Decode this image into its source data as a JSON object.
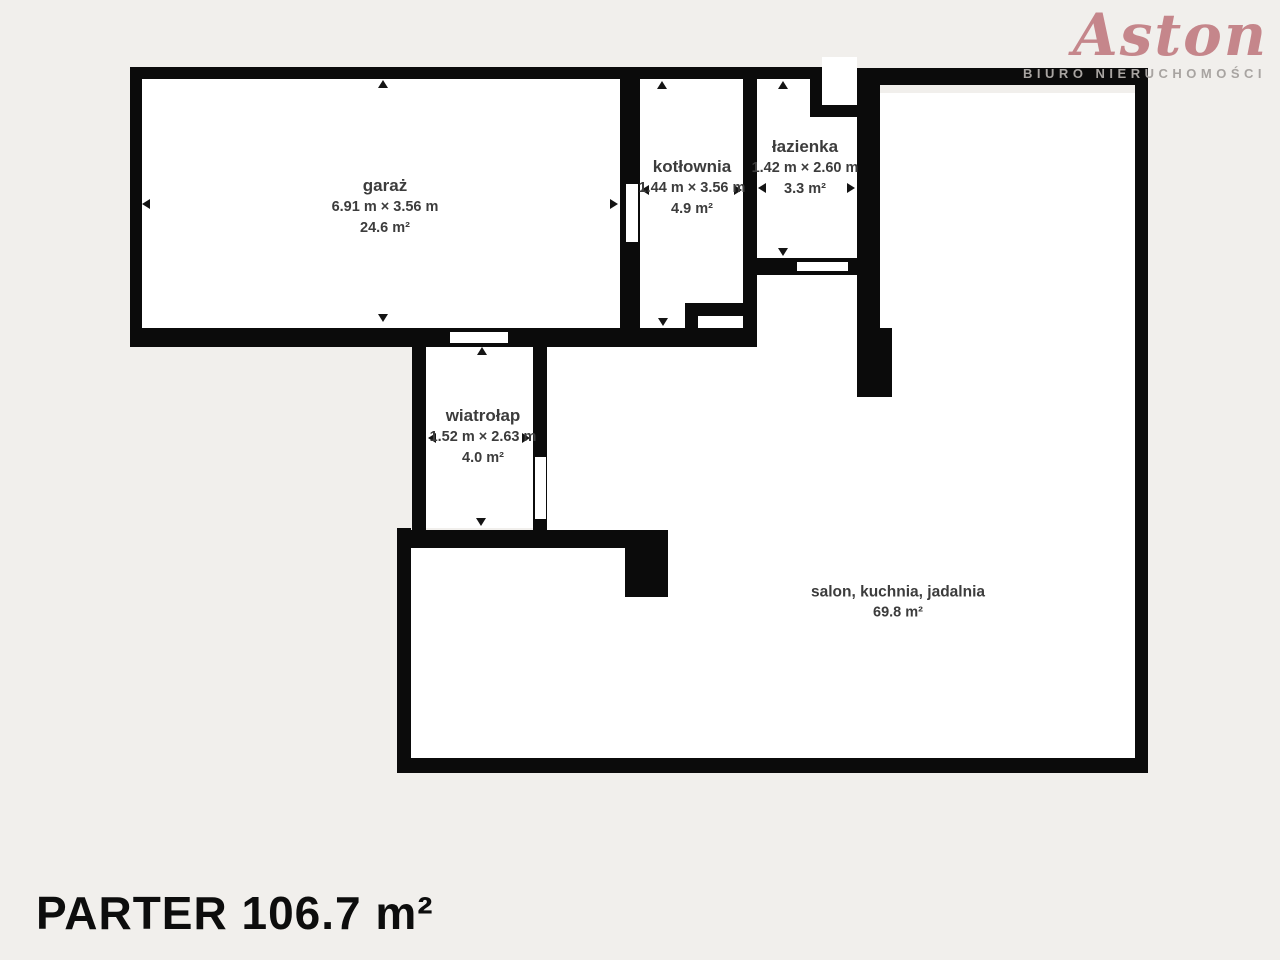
{
  "logo": {
    "brand": "Aston",
    "subtitle": "BIURO NIERUCHOMOŚCI"
  },
  "title": "PARTER 106.7 m²",
  "rooms": [
    {
      "name": "garaż",
      "dimensions": "6.91 m × 3.56 m",
      "area": "24.6 m²"
    },
    {
      "name": "kotłownia",
      "dimensions": "1.44 m × 3.56 m",
      "area": "4.9 m²"
    },
    {
      "name": "łazienka",
      "dimensions": "1.42 m × 2.60 m",
      "area": "3.3 m²"
    },
    {
      "name": "wiatrołap",
      "dimensions": "1.52 m × 2.63 m",
      "area": "4.0 m²"
    },
    {
      "name": "salon, kuchnia, jadalnia",
      "dimensions": "",
      "area": "69.8 m²"
    }
  ],
  "colors": {
    "background": "#f1efec",
    "wall": "#0b0b0b",
    "floor": "#ffffff",
    "label_text": "#3c3c3c",
    "brand": "#c5868b",
    "brand_subtitle": "#a8a4a1"
  }
}
